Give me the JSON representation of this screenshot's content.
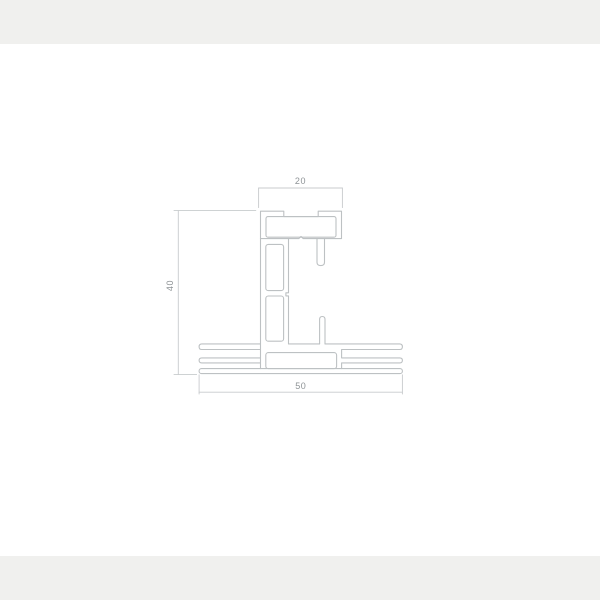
{
  "drawing": {
    "type": "technical-cross-section",
    "subject": "extrusion-profile",
    "dimensions": [
      {
        "id": "top-width",
        "value": "20",
        "orientation": "horizontal",
        "position": "top"
      },
      {
        "id": "left-height",
        "value": "40",
        "orientation": "vertical",
        "position": "left"
      },
      {
        "id": "bottom-width",
        "value": "50",
        "orientation": "horizontal",
        "position": "bottom"
      }
    ],
    "colors": {
      "outline": "#bdc1c3",
      "dimension_lines": "#c8cbcd",
      "text": "#8e9396",
      "background": "#ffffff",
      "page_edge": "#f0f0ee"
    }
  }
}
